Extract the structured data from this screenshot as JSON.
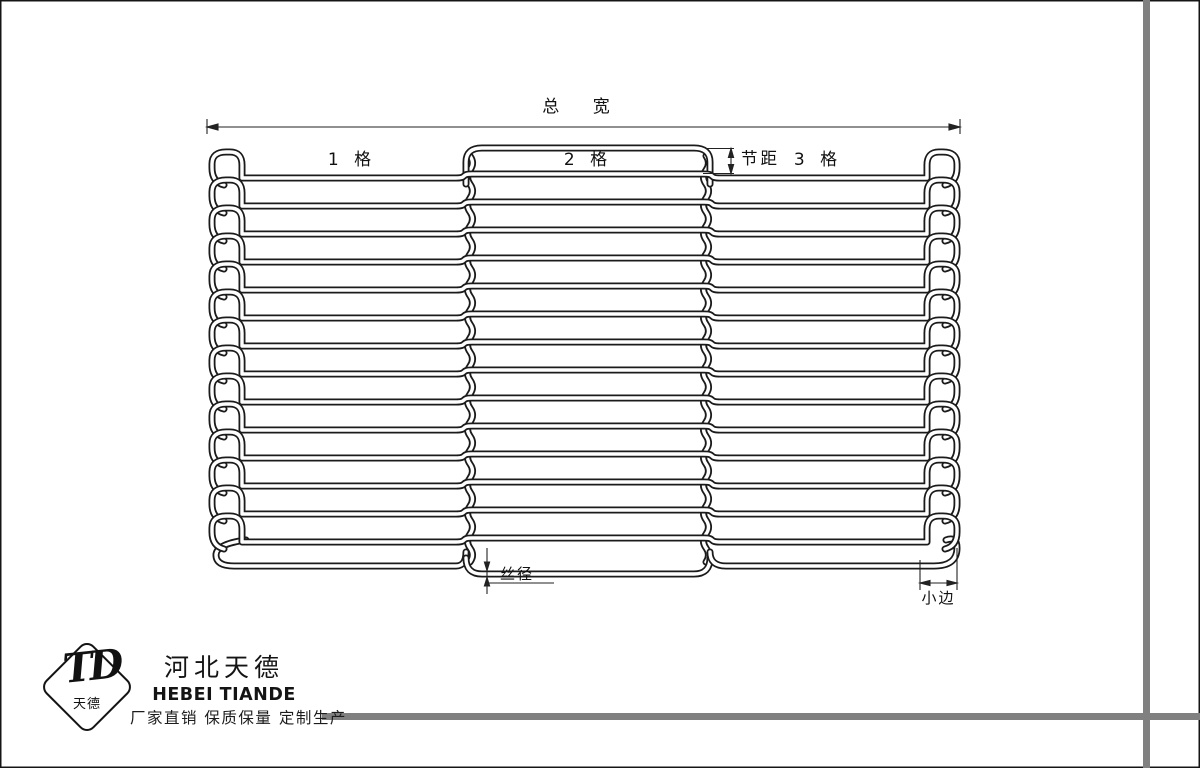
{
  "page": {
    "background": "#ffffff",
    "frame_bar_color": "#808080",
    "wire_color": "#1b1b1b"
  },
  "diagram": {
    "labels": {
      "total_width": "总 宽",
      "panel1": "1 格",
      "panel2": "2 格",
      "pitch": "节距",
      "panel3": "3 格",
      "wire_diameter": "丝径",
      "small_edge": "小边"
    },
    "belt": {
      "outer_left": 212,
      "inner_left": 242,
      "inner_right": 927,
      "outer_right": 957,
      "junction1": 470,
      "junction2": 706,
      "rows": 14,
      "pitch": 28,
      "first_row_y": 178,
      "mid_offset": -4,
      "mid_top_rail_y": 148,
      "side_bottom_rail_y": 566,
      "mid_bottom_rail_y": 574,
      "hook_rise": 26,
      "hook_drop": 7,
      "tube_width": 7,
      "core_width": 3.4
    }
  },
  "footer": {
    "logo_mark": "TD",
    "logo_text": "天德",
    "company_cn": "河北天德",
    "company_en": "HEBEI TIANDE",
    "slogan": "厂家直销 保质保量 定制生产"
  }
}
